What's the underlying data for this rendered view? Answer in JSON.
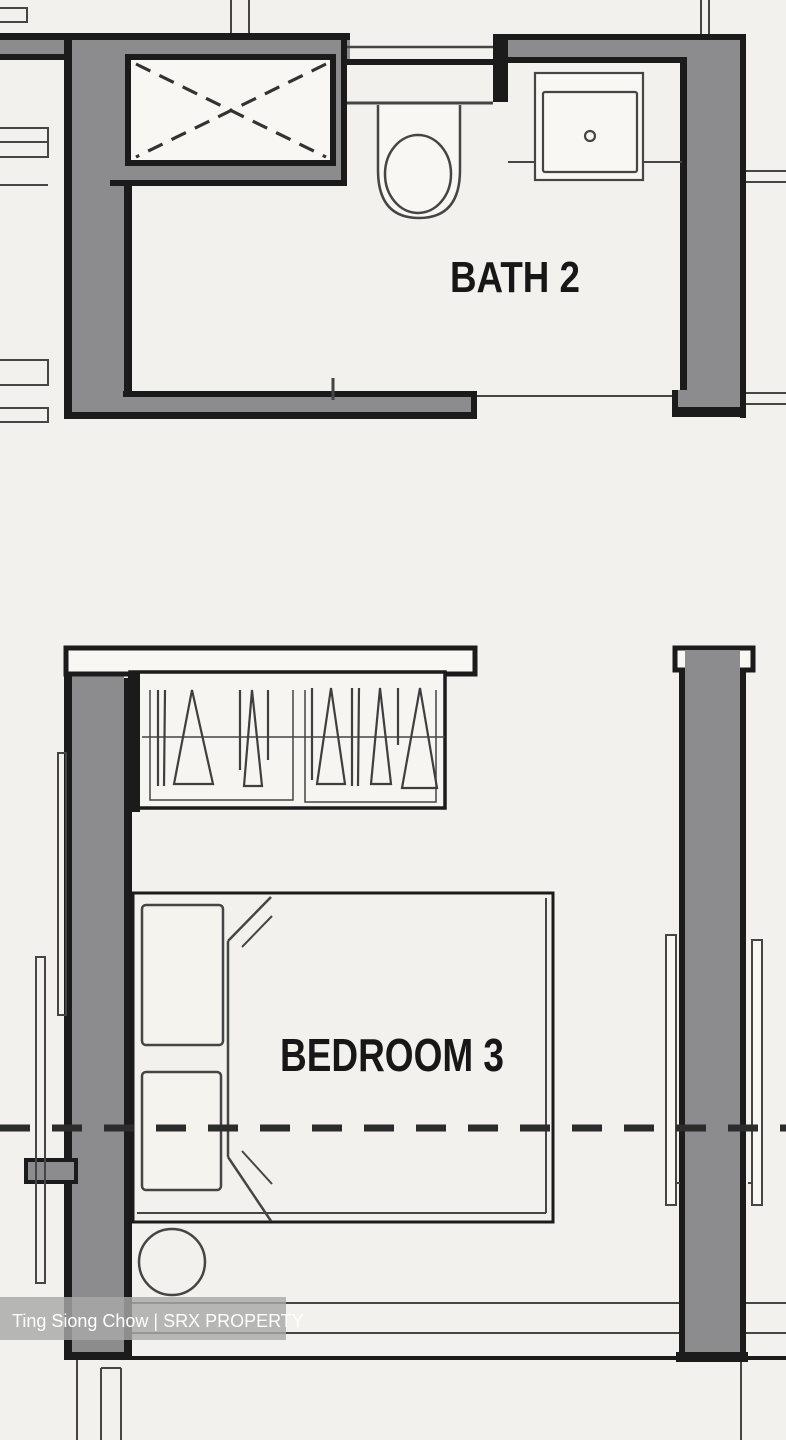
{
  "canvas": {
    "width": 786,
    "height": 1440
  },
  "colors": {
    "background": "#f2f1ed",
    "wall_gray": "#8c8c8e",
    "outline_black": "#1b1b1b",
    "thin_line": "#454545",
    "hanger_line": "#3f3f3f",
    "fixture_white": "#f8f7f3",
    "dash_line": "#2c2c2c",
    "label_text": "#171717",
    "watermark_bg": "#a8a8a8",
    "watermark_text": "#ffffff"
  },
  "labels": {
    "bath": {
      "text": "BATH 2"
    },
    "bedroom": {
      "text": "BEDROOM 3"
    }
  },
  "watermark": {
    "text": "Ting Siong Chow | SRX PROPERTY"
  },
  "fixtures": [
    "shower-stall-icon",
    "toilet-icon",
    "wash-basin-icon",
    "wardrobe-hangers-icon",
    "double-bed-icon",
    "pillow-icon",
    "side-stool-icon",
    "sliding-panel-icon",
    "window-glazing-icon",
    "section-cut-dashed-line"
  ]
}
